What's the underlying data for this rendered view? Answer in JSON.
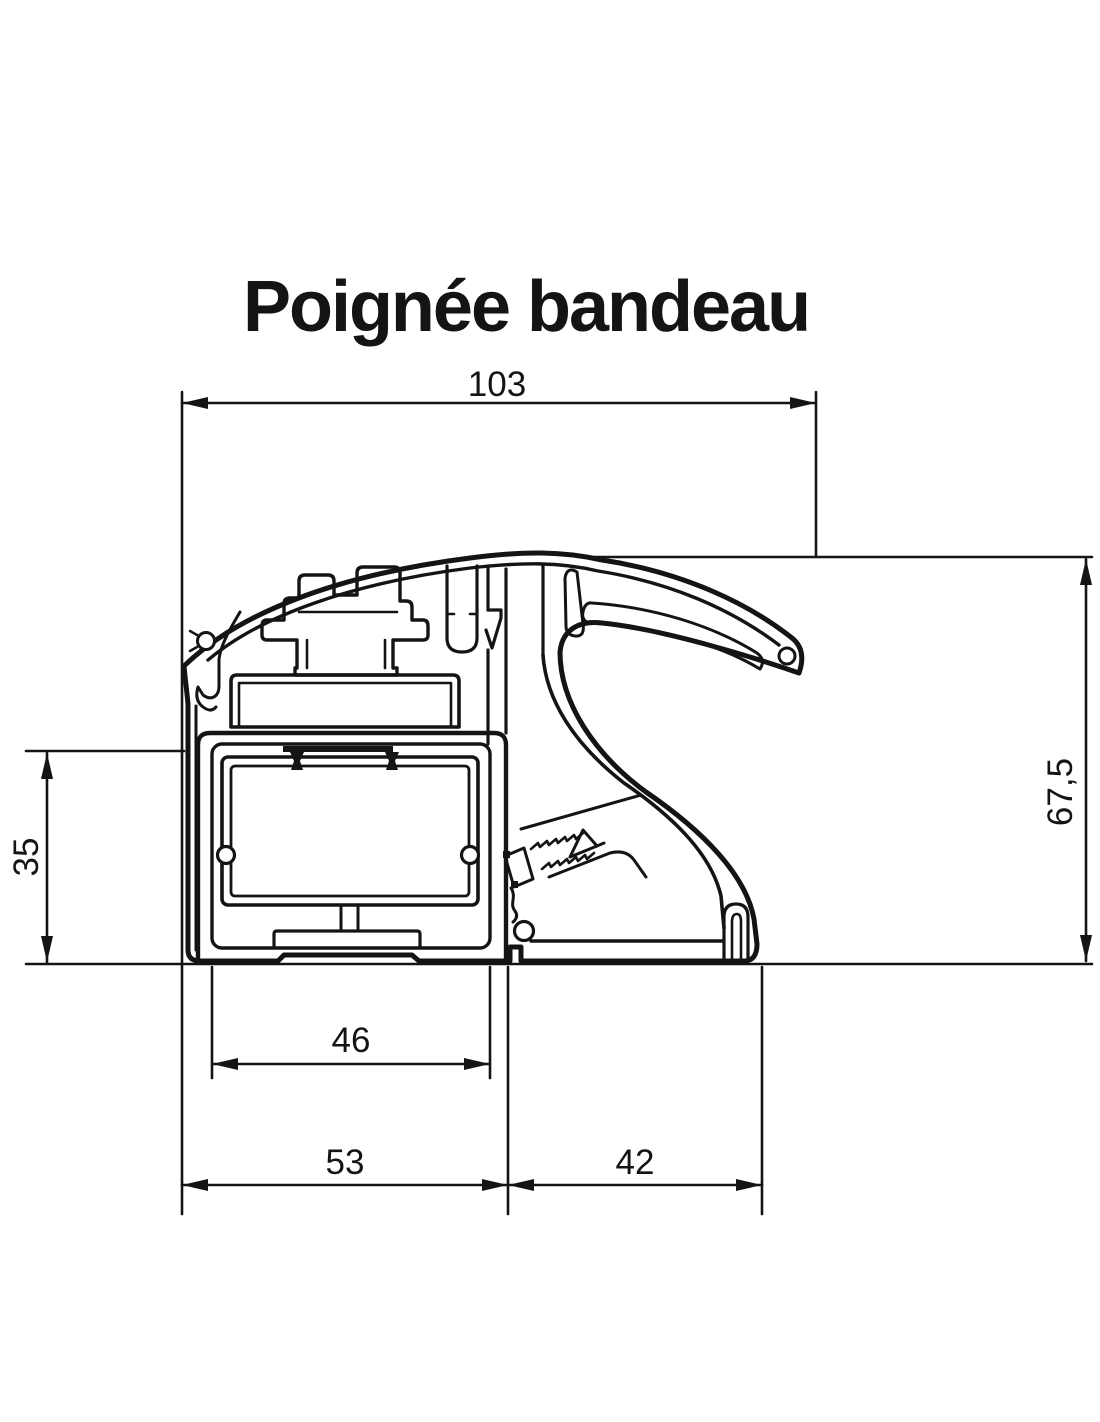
{
  "title": "Poignée bandeau",
  "dimensions": {
    "top_width": "103",
    "overall_height": "67,5",
    "box_height": "35",
    "inner_width": "46",
    "bottom_left": "53",
    "bottom_right": "42"
  },
  "colors": {
    "line": "#141414",
    "background": "#ffffff"
  }
}
